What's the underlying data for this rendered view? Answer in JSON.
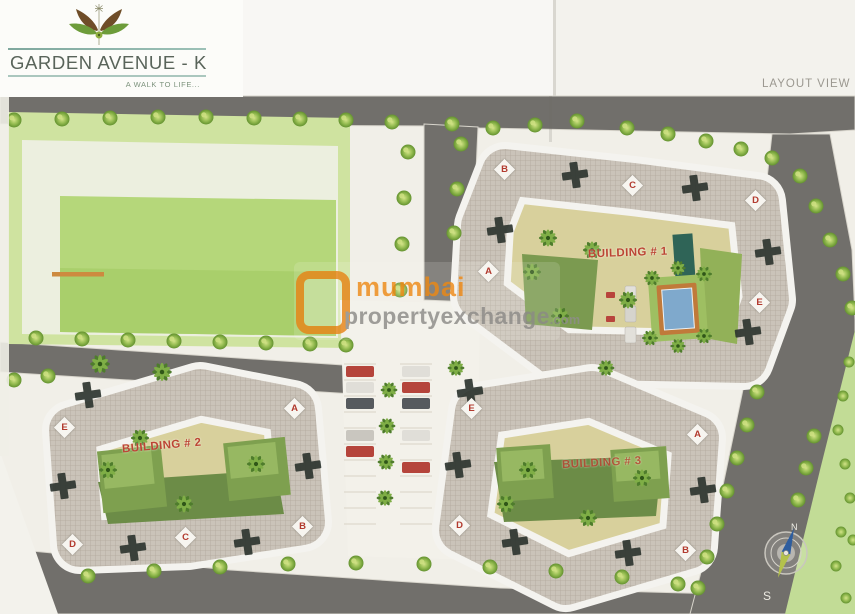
{
  "logo": {
    "title": "GARDEN AVENUE - K",
    "tagline": "A WALK TO LIFE..."
  },
  "header": {
    "view_label": "LAYOUT VIEW"
  },
  "watermark": {
    "brand": "mumbai",
    "brand2": "propertyexchange",
    "domain": ".com",
    "accent_color": "#e8871c",
    "text_color": "#8e8d89"
  },
  "site": {
    "buildings": [
      {
        "name": "BUILDING # 1",
        "wings": [
          "B",
          "C",
          "D",
          "A",
          "E"
        ]
      },
      {
        "name": "BUILDING # 2",
        "wings": [
          "E",
          "A",
          "B",
          "C",
          "D"
        ]
      },
      {
        "name": "BUILDING # 3",
        "wings": [
          "E",
          "A",
          "D",
          "B"
        ]
      }
    ],
    "compass": {
      "north": "N",
      "south": "S"
    }
  },
  "colors": {
    "road": "#716f6b",
    "lawn": "#cfe3a0",
    "lawn_bright": "#b5d77a",
    "roof": "#cac3b9",
    "courtyard": "#d8d09c",
    "label_red": "#bc4434",
    "pool_blue": "#7fa9cc",
    "pool_deck_orange": "#c07a3a",
    "tree_green": "#95bc51"
  }
}
